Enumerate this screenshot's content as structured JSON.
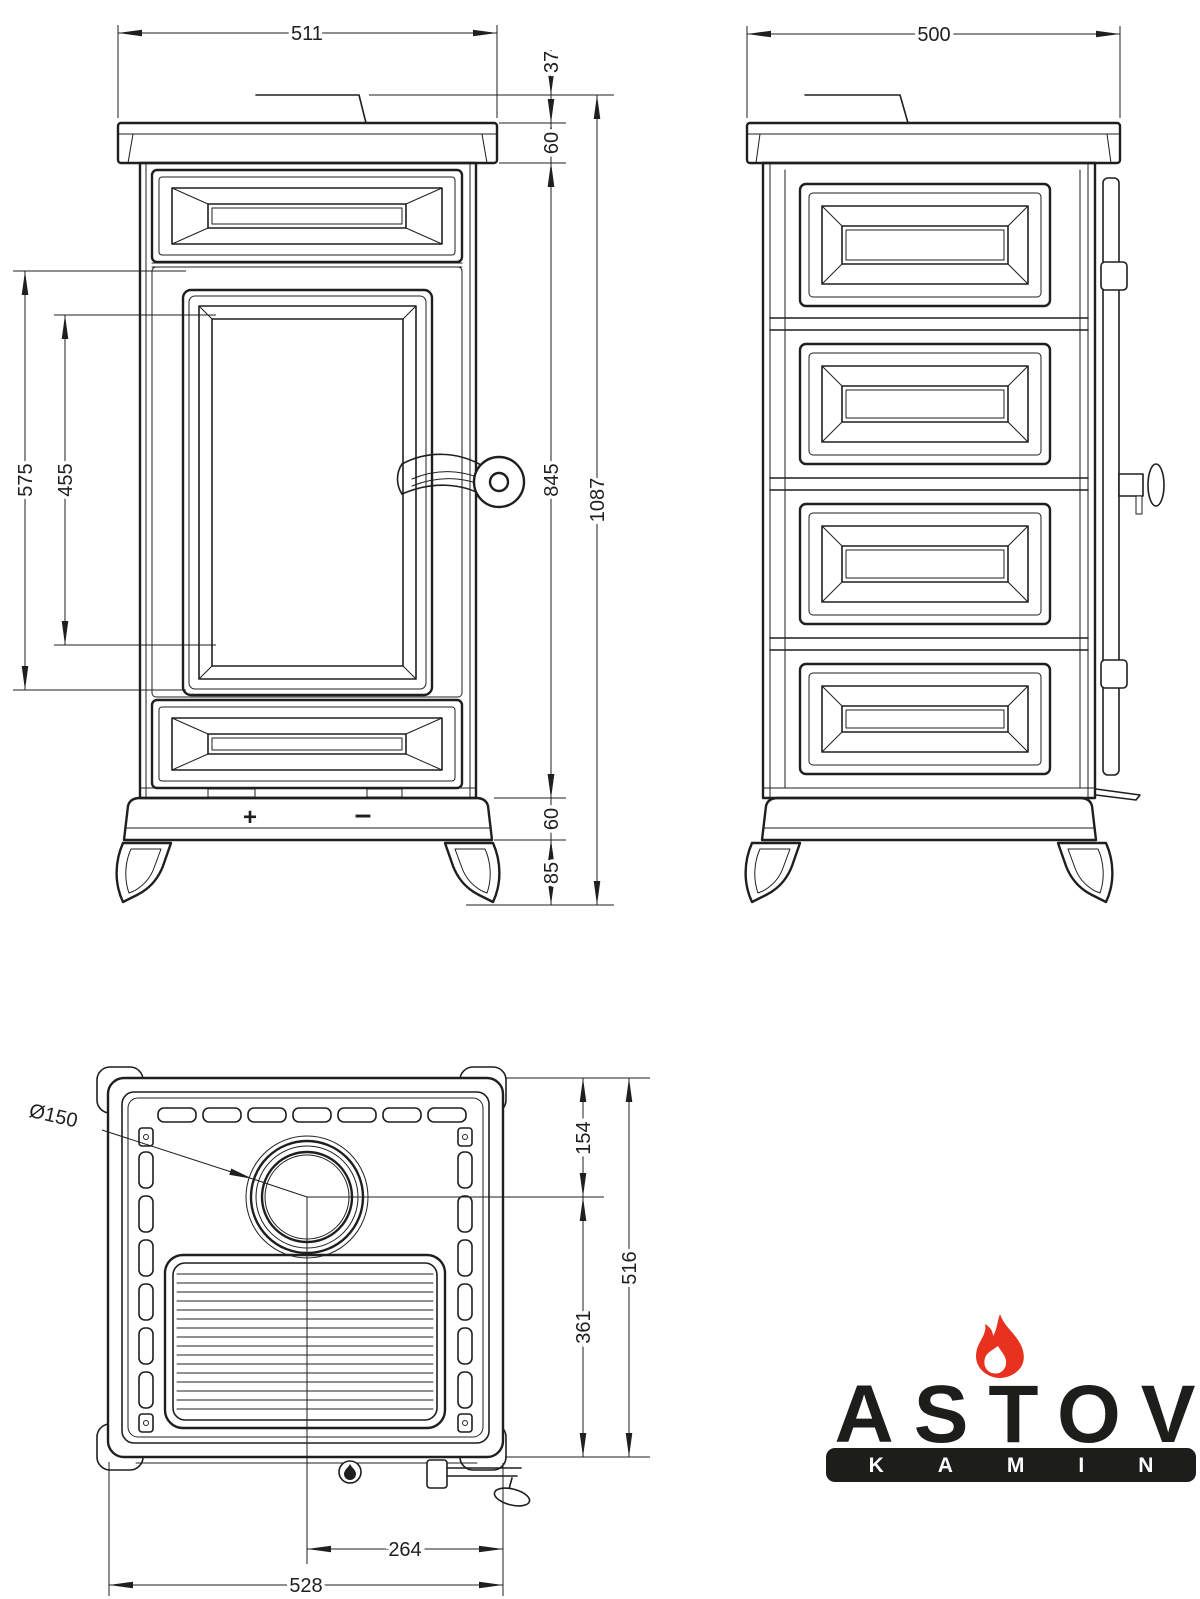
{
  "page": {
    "background": "#ffffff",
    "line_color": "#1f1f1f"
  },
  "front_view": {
    "dim_top_width": "511",
    "dim_flue_lip_height": "37",
    "dim_top_plate_height": "60",
    "dim_door_height": "575",
    "dim_glass_height": "455",
    "dim_body_height": "845",
    "dim_total_height": "1087",
    "dim_plinth_height": "60",
    "dim_leg_height": "85",
    "air_control_plus": "+",
    "air_control_minus": "–"
  },
  "side_view": {
    "dim_depth": "500"
  },
  "top_view": {
    "dim_flue_diameter": "Ø150",
    "dim_flue_center_to_back": "154",
    "dim_total_depth": "516",
    "dim_flue_center_to_front": "361",
    "dim_flue_center_offset": "264",
    "dim_total_width": "528"
  },
  "logo": {
    "brand": "ASTOV",
    "tagline": "KAMIN",
    "flame_color": "#e8311e",
    "ink": "#1d1d1b"
  }
}
